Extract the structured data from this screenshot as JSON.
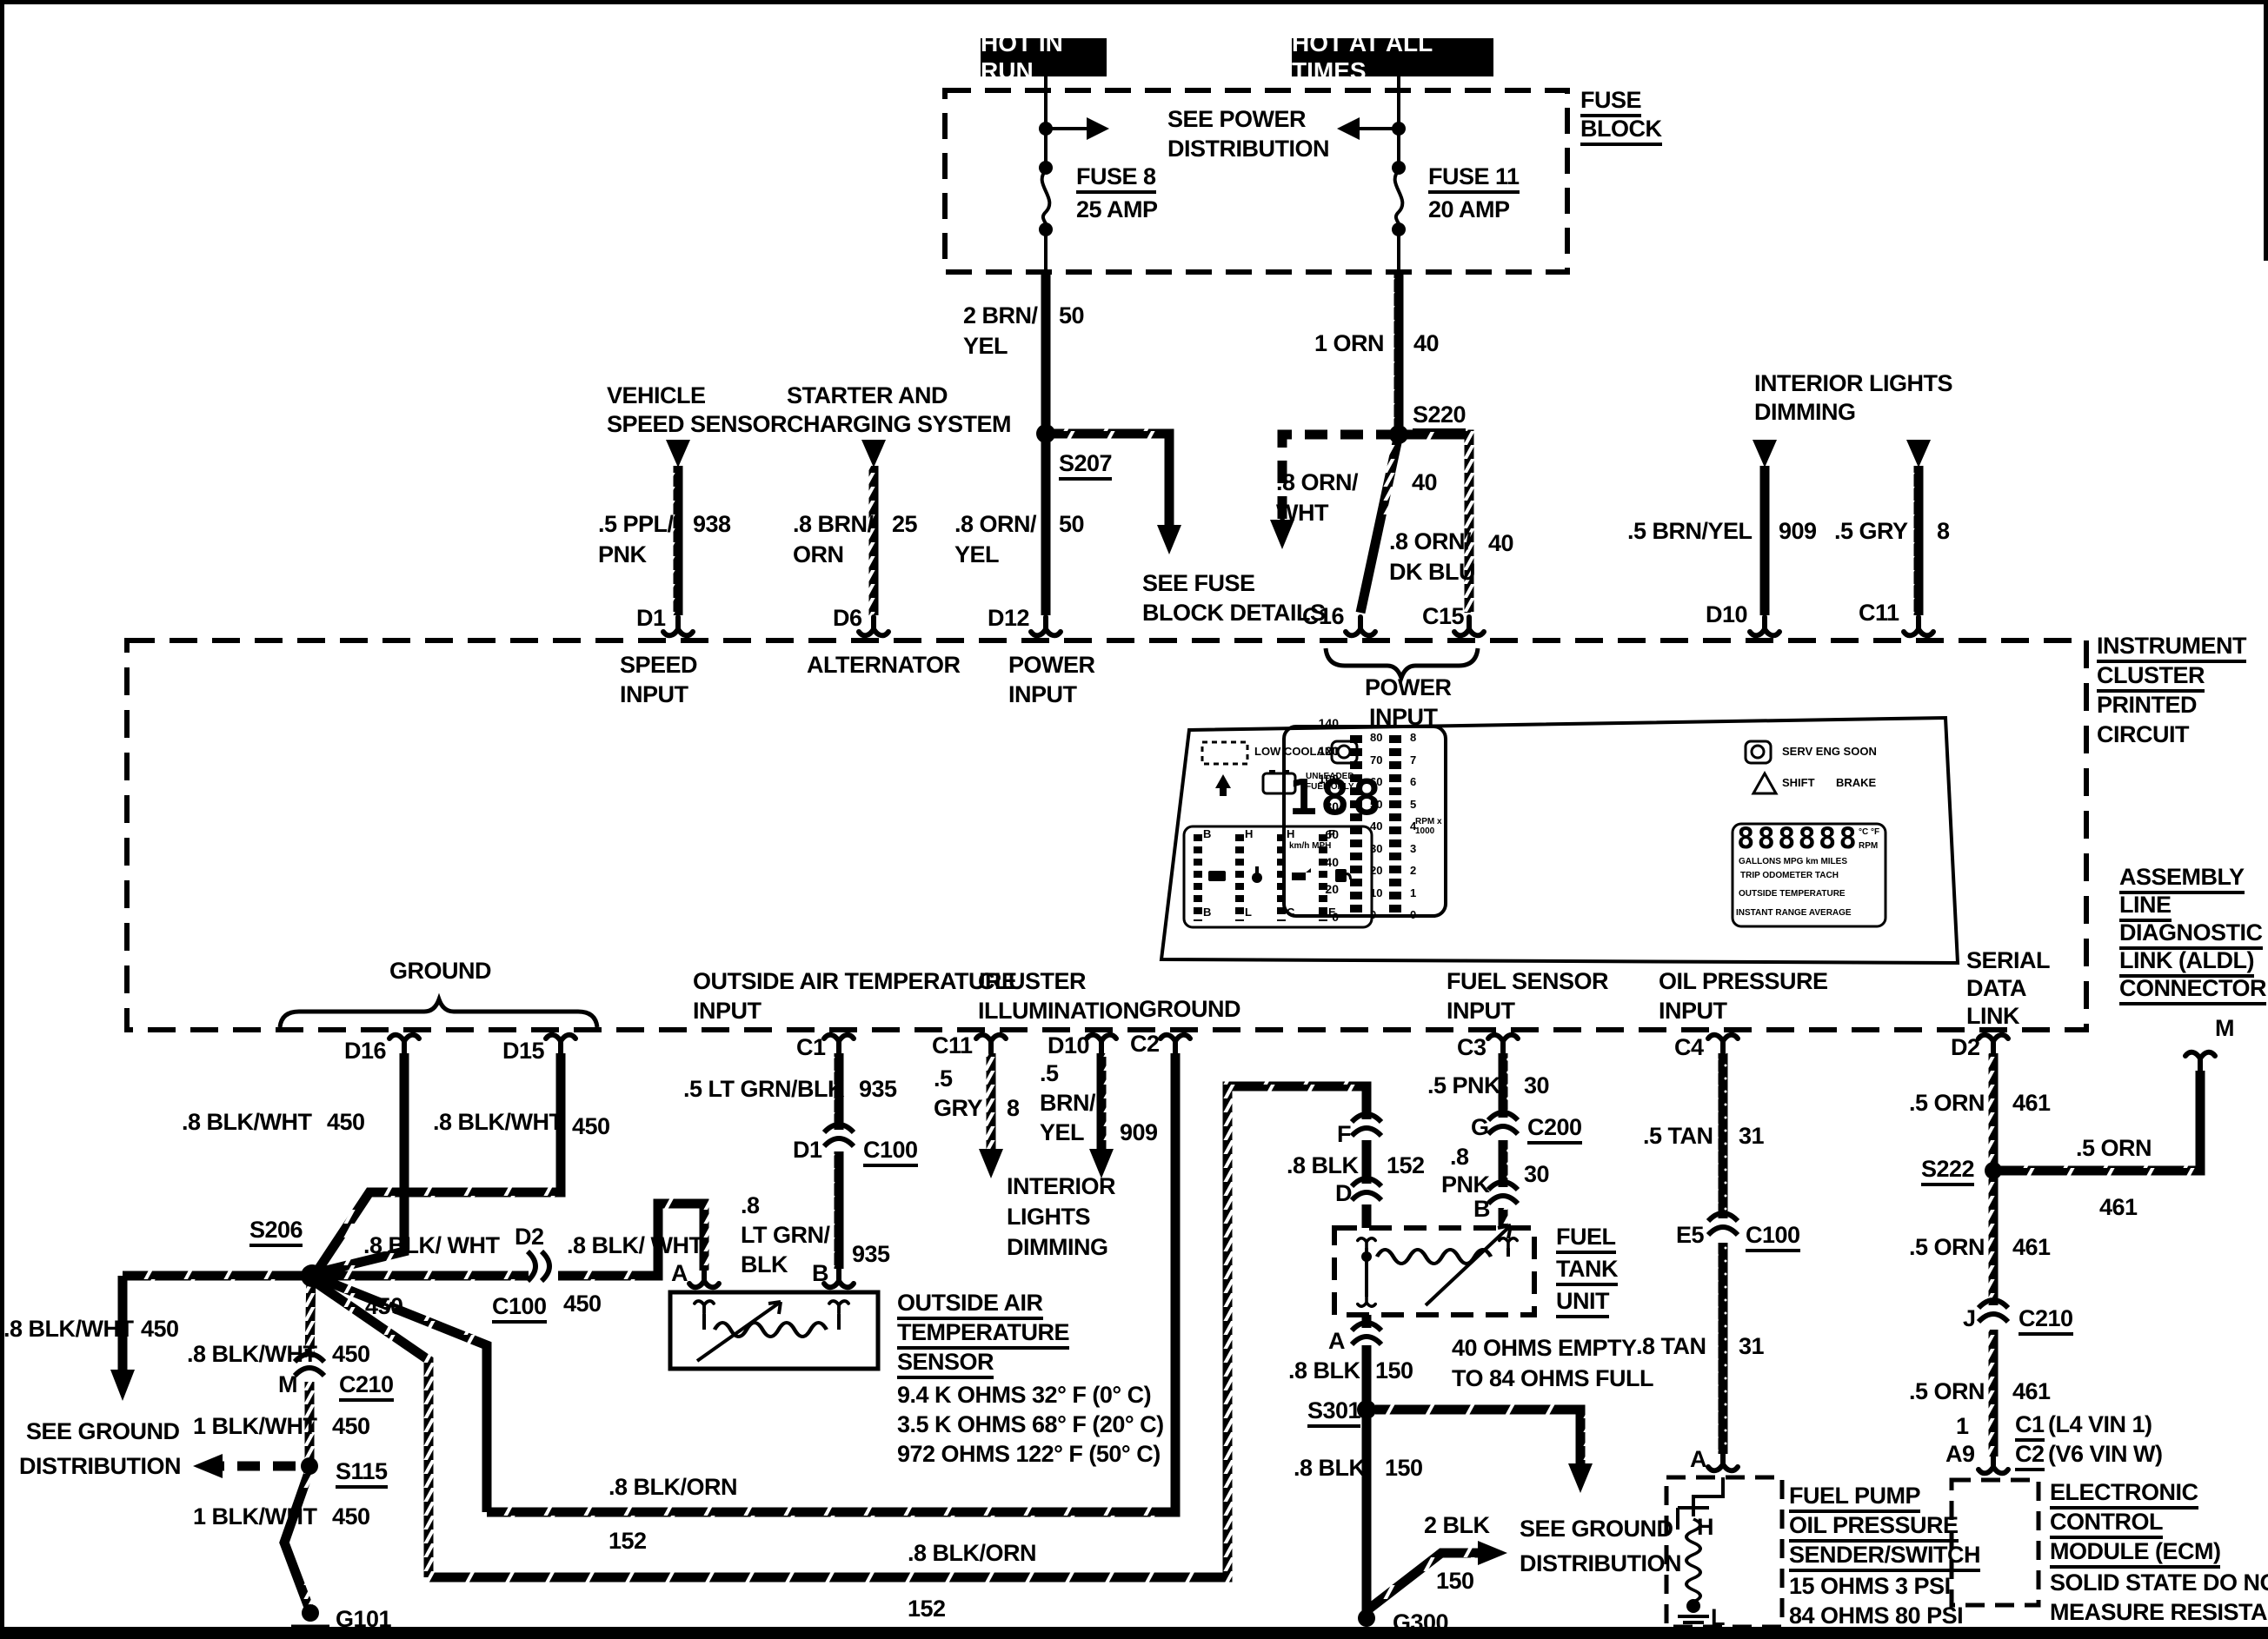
{
  "labels": {
    "hot_in_run": "HOT IN RUN",
    "hot_at_all_times": "HOT AT ALL TIMES",
    "fuse_block1": "FUSE",
    "fuse_block2": "BLOCK",
    "see_power1": "SEE POWER",
    "see_power2": "DISTRIBUTION",
    "fuse8": "FUSE 8",
    "fuse8_amp": "25 AMP",
    "fuse11": "FUSE 11",
    "fuse11_amp": "20 AMP",
    "w_2brn1": "2 BRN/",
    "w_2brn2": "YEL",
    "w_2brn_n": "50",
    "w_1orn": "1 ORN",
    "w_1orn_n": "40",
    "s207": "S207",
    "s220": "S220",
    "w_8ornyel1": ".8 ORN/",
    "w_8ornyel2": "YEL",
    "w_8ornyel_n": "50",
    "w_8ornwht1": ".8 ORN/",
    "w_8ornwht2": "WHT",
    "w_8ornwht_n": "40",
    "w_8orndkblu1": ".8 ORN/",
    "w_8orndkblu2": "DK BLU",
    "w_8orndkblu_n": "40",
    "see_fuse1": "SEE FUSE",
    "see_fuse2": "BLOCK DETAILS",
    "vss1": "VEHICLE",
    "vss2": "SPEED SENSOR",
    "w_5ppl1": ".5 PPL/",
    "w_5ppl2": "PNK",
    "w_5ppl_n": "938",
    "starter1": "STARTER AND",
    "starter2": "CHARGING SYSTEM",
    "w_8brn1": ".8 BRN/",
    "w_8brn2": "ORN",
    "w_8brn_n": "25",
    "ild1": "INTERIOR LIGHTS",
    "ild2": "DIMMING",
    "w_5brnyel": ".5 BRN/YEL",
    "w_5brnyel_n": "909",
    "w_5gry": ".5 GRY",
    "w_5gry_n": "8",
    "d1": "D1",
    "d6": "D6",
    "d12": "D12",
    "c16": "C16",
    "c15": "C15",
    "d10": "D10",
    "c11": "C11",
    "speed_in1": "SPEED",
    "speed_in2": "INPUT",
    "alternator": "ALTERNATOR",
    "power_in1a": "POWER",
    "power_in1b": "INPUT",
    "power_in2a": "POWER",
    "power_in2b": "INPUT",
    "instr1": "INSTRUMENT",
    "instr2": "CLUSTER",
    "instr3": "PRINTED",
    "instr4": "CIRCUIT",
    "low_coolant": "LOW COOLANT",
    "unleaded1": "UNLEADED",
    "unleaded2": "FUEL ONLY",
    "serv": "SERV ENG SOON",
    "shift": "SHIFT",
    "brake": "BRAKE",
    "spd_digits": "188",
    "spd_units": "km/h  MPH",
    "rpm1000": "RPM x 1000",
    "odo_digits": "888888",
    "cf": "°C °F",
    "rpm": "RPM",
    "row1": "GALLONS  MPG  km  MILES",
    "row2": "TRIP ODOMETER TACH",
    "row3": "OUTSIDE TEMPERATURE",
    "row4": "INSTANT RANGE AVERAGE",
    "ground1": "GROUND",
    "d16": "D16",
    "d15": "D15",
    "w450a": ".8 BLK/WHT",
    "w450a_n": "450",
    "w450b": ".8 BLK/WHT",
    "w450b_n": "450",
    "s206": "S206",
    "w450c": ".8 BLK/ WHT",
    "d2a": "D2",
    "w450d": ".8 BLK/ WHT",
    "c100a": "C100",
    "c100a_n": "450",
    "w450dot_n": "450",
    "w450L": ".8 BLK/WHT",
    "w450L_n": "450",
    "seegnd1a": "SEE GROUND",
    "seegnd1b": "DISTRIBUTION",
    "w450m": ".8 BLK/WHT",
    "w450m_n": "450",
    "m1": "M",
    "c210a": "C210",
    "w1blk_a": "1 BLK/WHT",
    "w1blk_a_n": "450",
    "s115": "S115",
    "w1blk_b": "1 BLK/WHT",
    "w1blk_b_n": "450",
    "g101": "G101",
    "oat1": "OUTSIDE AIR TEMPERATURE",
    "oat2": "INPUT",
    "ci1": "CLUSTER",
    "ci2": "ILLUMINATION",
    "ground2": "GROUND",
    "c1b": "C1",
    "c11b": "C11",
    "d10b": "D10",
    "c2b": "C2",
    "w935a": ".5 LT GRN/BLK",
    "w935a_n": "935",
    "w5gryb1": ".5",
    "w5gryb2": "GRY",
    "w5gryb_n": "8",
    "w5byb1": ".5",
    "w5byb2": "BRN/",
    "w5byb3": "YEL",
    "w5byb_n": "909",
    "d1b": "D1",
    "c100b": "C100",
    "w935b1": ".8",
    "w935b2": "LT GRN/",
    "w935b3": "BLK",
    "w935b_n": "935",
    "ildb1": "INTERIOR",
    "ildb2": "LIGHTS",
    "ildb3": "DIMMING",
    "a_oat": "A",
    "b_oat": "B",
    "oats1": "OUTSIDE AIR",
    "oats2": "TEMPERATURE",
    "oats3": "SENSOR",
    "oats4": "9.4 K OHMS 32° F (0° C)",
    "oats5": "3.5 K OHMS 68° F (20° C)",
    "oats6": "972 OHMS 122° F (50° C)",
    "blkorn1": ".8 BLK/ORN",
    "blkorn1_n": "152",
    "blkorn2": ".8 BLK/ORN",
    "blkorn2_n": "152",
    "fsi1": "FUEL SENSOR",
    "fsi2": "INPUT",
    "c3": "C3",
    "w5pnk": ".5 PNK",
    "w5pnk_n": "30",
    "g_t": "G",
    "c200": "C200",
    "w8pnk1": ".8",
    "w8pnk2": "PNK",
    "w8pnk_n": "30",
    "b_t": "B",
    "f_t": "F",
    "w8blk152": ".8 BLK",
    "w8blk152_n": "152",
    "d_t": "D",
    "ftu1": "FUEL",
    "ftu2": "TANK",
    "ftu3": "UNIT",
    "a_ftu": "A",
    "w8blk150a": ".8 BLK",
    "w8blk150a_n": "150",
    "ohms1": "40 OHMS EMPTY",
    "ohms2": "TO 84 OHMS FULL",
    "s301": "S301",
    "w8blk150b": ".8 BLK",
    "w8blk150b_n": "150",
    "w2blk": "2 BLK",
    "w2blk_n": "150",
    "seegnd2a": "SEE GROUND",
    "seegnd2b": "DISTRIBUTION",
    "g300": "G300",
    "opi1": "OIL PRESSURE",
    "opi2": "INPUT",
    "c4": "C4",
    "w5tan": ".5 TAN",
    "w5tan_n": "31",
    "e5": "E5",
    "c100c": "C100",
    "w8tan": ".8 TAN",
    "w8tan_n": "31",
    "a_fp": "A",
    "h_t": "H",
    "l_t": "L",
    "fp1": "FUEL PUMP",
    "fp2": "OIL PRESSURE",
    "fp3": "SENDER/SWITCH",
    "fp4": "15 OHMS 3 PSI",
    "fp5": "84 OHMS 80 PSI",
    "sdl1": "SERIAL",
    "sdl2": "DATA",
    "sdl3": "LINK",
    "aldl1": "ASSEMBLY",
    "aldl2": "LINE",
    "aldl3": "DIAGNOSTIC",
    "aldl4": "LINK (ALDL)",
    "aldl5": "CONNECTOR",
    "m2": "M",
    "d2b": "D2",
    "w5orn_a": ".5 ORN",
    "w5orn_a_n": "461",
    "s222": "S222",
    "w5orn_m": ".5 ORN",
    "w5orn_m_n": "461",
    "w5orn_b": ".5 ORN",
    "w5orn_b_n": "461",
    "j_t": "J",
    "c210b": "C210",
    "w5orn_c": ".5 ORN",
    "w5orn_c_n": "461",
    "one": "1",
    "a9": "A9",
    "c1e": "C1",
    "c1e_s": "(L4 VIN 1)",
    "c2e": "C2",
    "c2e_s": "(V6 VIN W)",
    "ecm1": "ELECTRONIC",
    "ecm2": "CONTROL",
    "ecm3": "MODULE (ECM)",
    "ecm4": "SOLID STATE DO NOT",
    "ecm5": "MEASURE RESISTANCE"
  },
  "cluster": {
    "kmh_scale": [
      "140",
      "120",
      "100",
      "80",
      "60",
      "40",
      "20",
      "0"
    ],
    "mph_scale": [
      "80",
      "70",
      "60",
      "50",
      "40",
      "30",
      "20",
      "10",
      "0"
    ],
    "tach_scale": [
      "8",
      "7",
      "6",
      "5",
      "4",
      "3",
      "2",
      "1",
      "0"
    ],
    "gauge_top": [
      "B",
      "H",
      "H",
      "F"
    ],
    "gauge_bottom": [
      "B",
      "L",
      "C",
      "E"
    ]
  }
}
